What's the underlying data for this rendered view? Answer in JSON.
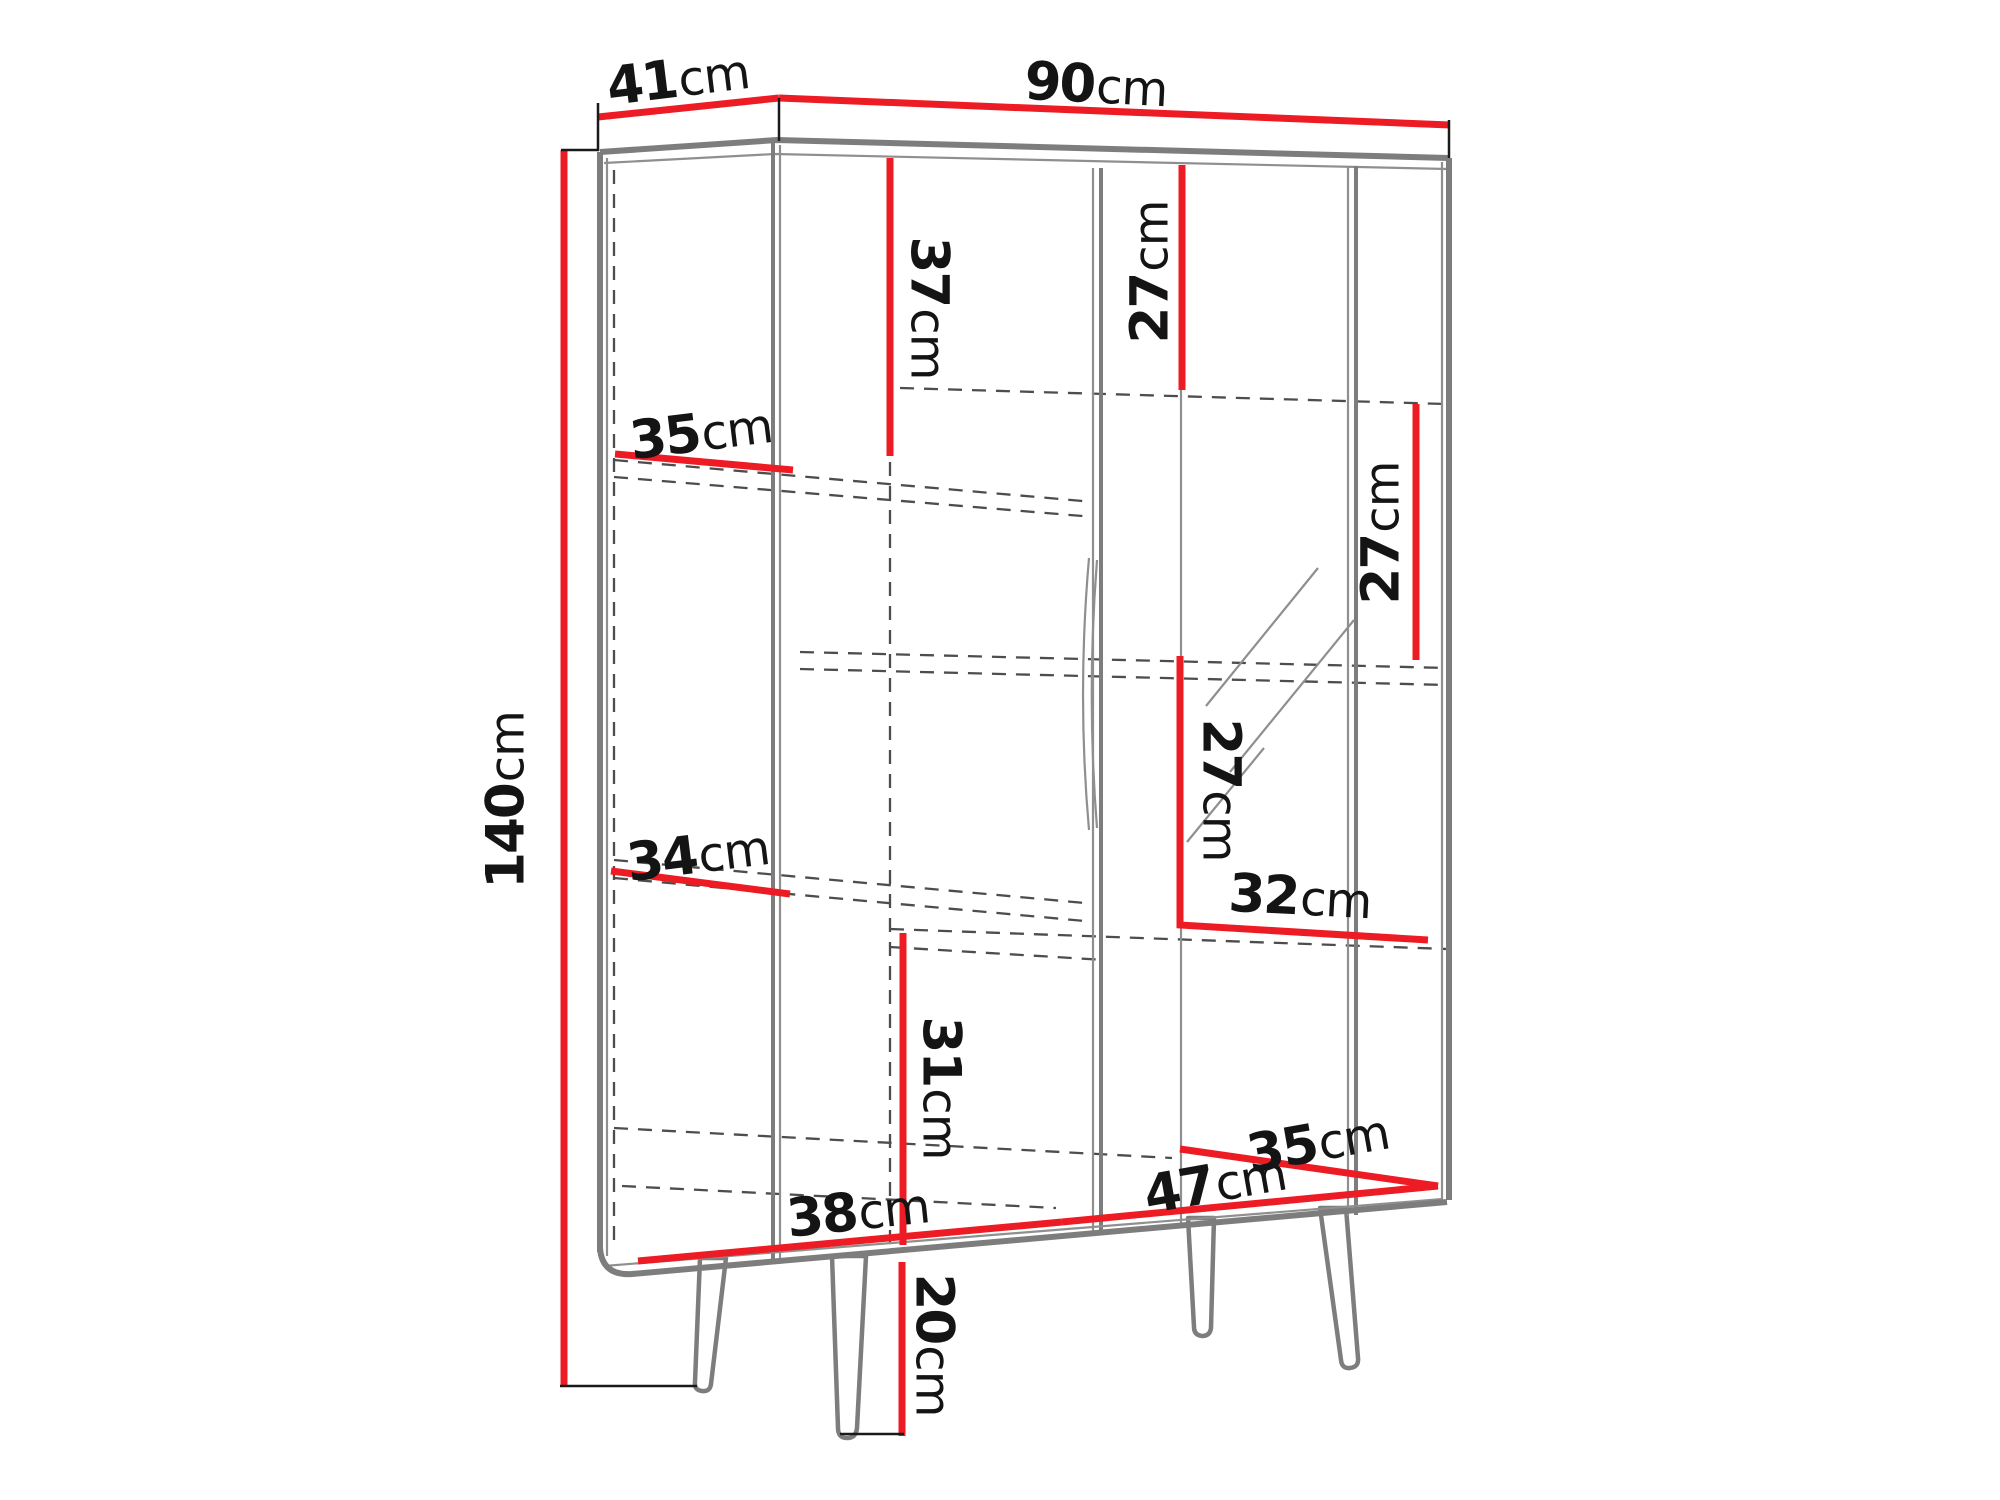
{
  "diagram": {
    "type": "furniture-dimension-drawing",
    "subject": "display cabinet on splayed legs, front-left perspective line drawing",
    "unit": "cm",
    "colors": {
      "dimension_line": "#ed1c24",
      "outline": "#7d7d7d",
      "hidden_edge": "#4d4d4d",
      "label_text": "#141414",
      "background": "#ffffff"
    }
  },
  "labels": [
    {
      "id": "depth-top",
      "num": "41",
      "unit": "cm"
    },
    {
      "id": "width-top",
      "num": "90",
      "unit": "cm"
    },
    {
      "id": "height-total",
      "num": "140",
      "unit": "cm"
    },
    {
      "id": "upper-left-section-height",
      "num": "37",
      "unit": "cm"
    },
    {
      "id": "upper-middle-section-height",
      "num": "27",
      "unit": "cm"
    },
    {
      "id": "right-section-height",
      "num": "27",
      "unit": "cm"
    },
    {
      "id": "middle-section-height",
      "num": "27",
      "unit": "cm"
    },
    {
      "id": "left-shelf-width-upper",
      "num": "35",
      "unit": "cm"
    },
    {
      "id": "left-shelf-width-lower",
      "num": "34",
      "unit": "cm"
    },
    {
      "id": "right-shelf-width",
      "num": "32",
      "unit": "cm"
    },
    {
      "id": "lower-section-height",
      "num": "31",
      "unit": "cm"
    },
    {
      "id": "bottom-depth",
      "num": "35",
      "unit": "cm"
    },
    {
      "id": "bottom-width-right",
      "num": "47",
      "unit": "cm"
    },
    {
      "id": "bottom-width-left",
      "num": "38",
      "unit": "cm"
    },
    {
      "id": "leg-height",
      "num": "20",
      "unit": "cm"
    }
  ]
}
